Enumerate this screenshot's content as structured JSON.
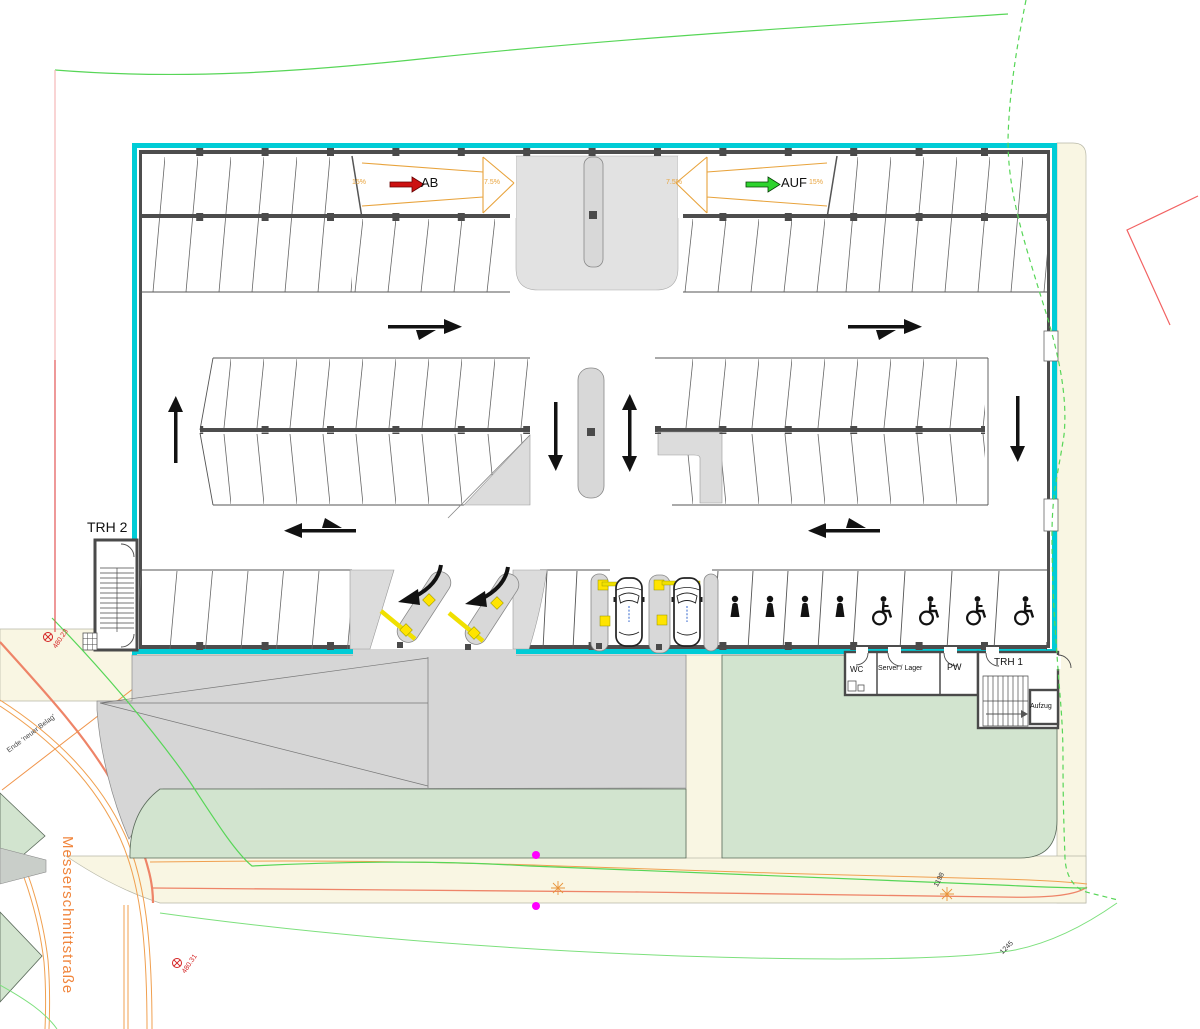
{
  "plan": {
    "building": {
      "ramp_down_label": "AB",
      "ramp_up_label": "AUF",
      "slope_down_outer": "15%",
      "slope_down_inner": "7.5%",
      "slope_up_inner": "7.5%",
      "slope_up_outer": "15%",
      "stair_west": "TRH 2",
      "stair_east": "TRH 1",
      "room_wc": "WC",
      "room_server": "Server / Lager",
      "room_pw": "PW",
      "room_elevator": "Aufzug"
    },
    "site": {
      "street_name": "Messerschmittstraße",
      "pavement_note": "Ende 'neuer Belag'",
      "survey_marker_north": "480.23",
      "survey_marker_south": "480.31",
      "elevation_east_1": "1198",
      "elevation_east_2": "1245"
    },
    "colors": {
      "building_outline_cyan": "#00ccd6",
      "ramp_marking_orange": "#e8a33c",
      "arrow_down_red": "#cc1111",
      "arrow_up_green": "#2ed32e",
      "site_boundary_green": "#57d657",
      "site_boundary_red": "#f26262",
      "street_label_orange": "#f0853c",
      "survey_marker_red": "#d42222",
      "landscape_green": "#d2e4cf",
      "pavement_beige": "#f9f6e3",
      "ev_marking_yellow": "#ffe400",
      "survey_point_magenta": "#ff00ff"
    }
  }
}
